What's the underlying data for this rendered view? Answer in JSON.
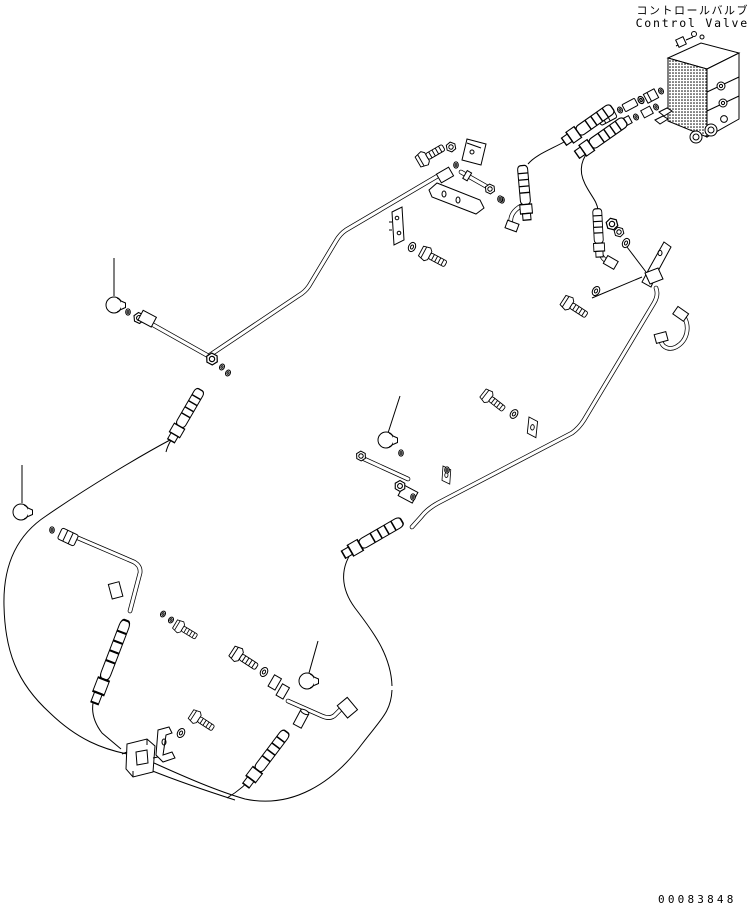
{
  "header": {
    "title_jp": "コントロールバルブ",
    "title_en": "Control Valve"
  },
  "footer": {
    "drawing_number": "00083848"
  },
  "colors": {
    "line": "#000000",
    "background": "#ffffff"
  },
  "diagram": {
    "type": "exploded-parts-diagram",
    "subject": "Control Valve hydraulic piping",
    "parts": [
      "control-valve-block",
      "inlet-adapter-chain",
      "inlet-hose-crimp-fittings",
      "hose-a",
      "hose-b",
      "vertical-crimp-tube-a",
      "vertical-crimp-tube-b",
      "elbow-fitting-a",
      "elbow-fitting-b",
      "right-mounting-bracket",
      "right-pipe",
      "hook-hose",
      "upper-left-pipe",
      "upper-left-plug-chain",
      "lever-clamp-assembly",
      "clamp-plates",
      "tee-connector-cluster",
      "s-curve-hose",
      "left-sweep-hose",
      "lower-left-plug-chain",
      "lower-left-tube",
      "double-clamp-block",
      "u-clamp-bracket",
      "elbow-tube-assembly",
      "bolts",
      "washers",
      "nuts",
      "o-rings",
      "plugs",
      "leader-lines"
    ]
  }
}
